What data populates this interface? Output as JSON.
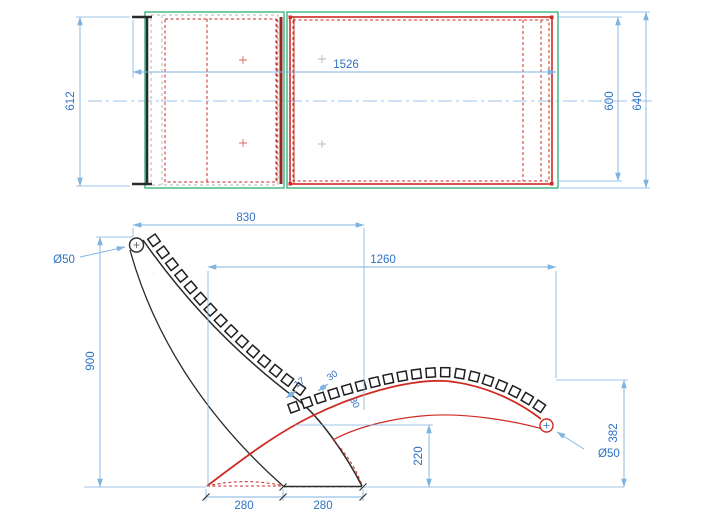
{
  "drawing": {
    "type": "technical-drawing",
    "subject": "chaise-lounge-two-view-dimensioned-drawing",
    "views": {
      "top": {
        "dims": {
          "overall_length": "1526",
          "frame_width": "612",
          "bed_width": "600",
          "overall_width": "640"
        }
      },
      "side": {
        "dims": {
          "backrest_span": "830",
          "seat_span": "1260",
          "backrest_height": "900",
          "seat_tip_height": "382",
          "seat_under_height": "220",
          "base_front": "280",
          "base_rear": "280",
          "slat_gap": "17",
          "slat_pitch": "30",
          "slat_depth": "30",
          "backrest_tube_diameter": "Ø50",
          "seat_tube_diameter": "Ø50",
          "micro_mark_backrest": "···",
          "micro_mark_seat_tip": "···"
        },
        "slats": {
          "backrest_count": 15,
          "seat_count": 19,
          "size_px": 9
        }
      }
    },
    "colors": {
      "dimtext": "#2f72c4",
      "dimline": "#7fb3e0",
      "green": "#3cb37f",
      "red": "#cf2b24",
      "darkred": "#8a2a22",
      "black": "#2b2b2b",
      "gray": "#b3b3b3",
      "center": "#8fc3ea"
    }
  }
}
